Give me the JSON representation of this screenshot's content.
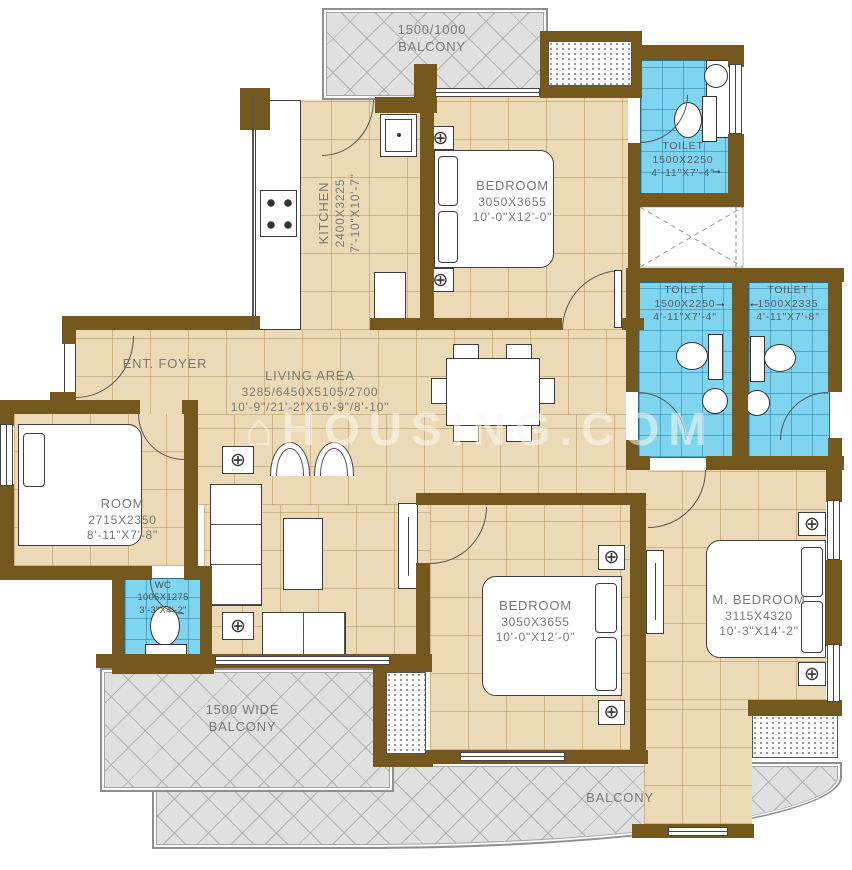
{
  "watermark": {
    "icon": "⌂",
    "text": "HOUSING.COM"
  },
  "icons": {
    "crosshair": "⊕",
    "arrow_right": "→",
    "arrow_left": "←"
  },
  "colors": {
    "wall": "#75581d",
    "floor": "#ecdab6",
    "toilet": "#7fd4ef",
    "balcony": "#e0e0e0",
    "label": "#787878"
  },
  "rooms": {
    "balcony_top": {
      "dim": "1500/1000",
      "name": "BALCONY"
    },
    "kitchen": {
      "name": "KITCHEN",
      "mm": "2400X3225",
      "ft": "7'-10\"X10'-7\""
    },
    "bedroom_top": {
      "name": "BEDROOM",
      "mm": "3050X3655",
      "ft": "10'-0\"X12'-0\""
    },
    "toilet_top": {
      "name": "TOILET",
      "mm": "1500X2250",
      "ft": "4'-11\"X7'-4\""
    },
    "toilet_mid_left": {
      "name": "TOILET",
      "mm": "1500X2250",
      "ft": "4'-11\"X7'-4\""
    },
    "toilet_mid_right": {
      "name": "TOILET",
      "mm": "1500X2335",
      "ft": "4'-11\"X7'-8\""
    },
    "ent_foyer": {
      "name": "ENT. FOYER"
    },
    "living": {
      "name": "LIVING AREA",
      "mm": "3285/6450X5105/2700",
      "ft": "10'-9\"/21'-2\"X16'-9\"/8'-10\""
    },
    "room": {
      "name": "ROOM",
      "mm": "2715X2350",
      "ft": "8'-11\"X7'-8\""
    },
    "wc": {
      "name": "WC",
      "mm": "1005X1275",
      "ft": "3'-3\"X4'-2\""
    },
    "bedroom_bottom": {
      "name": "BEDROOM",
      "mm": "3050X3655",
      "ft": "10'-0\"X12'-0\""
    },
    "m_bedroom": {
      "name": "M. BEDROOM",
      "mm": "3115X4320",
      "ft": "10'-3\"X14'-2\""
    },
    "balcony_left": {
      "dim": "1500 WIDE",
      "name": "BALCONY"
    },
    "balcony_bottom": {
      "name": "BALCONY"
    }
  }
}
